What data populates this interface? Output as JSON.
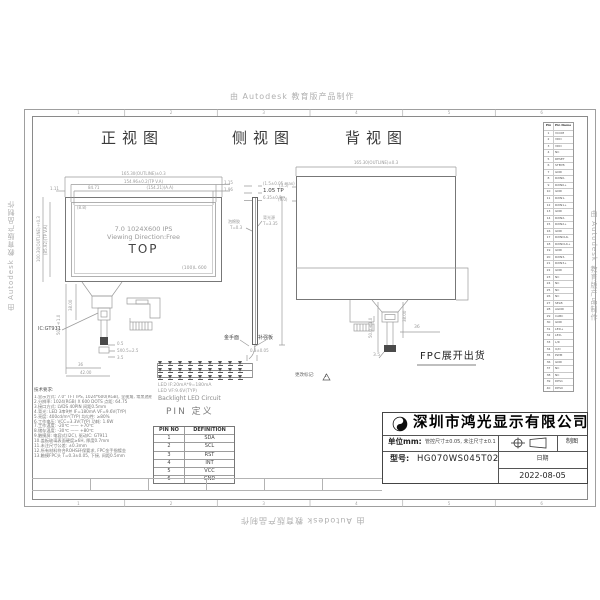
{
  "watermark": {
    "text": "由 Autodesk 教育版产品制作"
  },
  "zones": {
    "digits": [
      "1",
      "2",
      "3",
      "4",
      "5",
      "6"
    ]
  },
  "views": {
    "front": "正视图",
    "side": "侧视图",
    "back": "背视图"
  },
  "front": {
    "dim_outline": "165.30(OUTLINE)±0.3",
    "dim_tp": "154.96±0.2(TP V.A)",
    "dim_aa": "(154.21)(A.A)",
    "dim_aa_mid": "84.71",
    "dim_left_stub": "1.11",
    "dim_right_stub1": "1.15",
    "dim_right_stub2": "1.96",
    "dim_v_outline": "100.30(OUTLINE)±0.3",
    "dim_v_va": "(85.92)(TP V.A)",
    "corner_note": "(8.8)",
    "panel_line1": "7.0 1024X600 IPS",
    "panel_line2": "Viewing Direction:Free",
    "panel_line3": "TOP",
    "panel_corner": "(100)L 600",
    "ic_label": "IC:GT911",
    "fpc_len": "50.0±1.0",
    "fpc_38": "38.00",
    "fpc_d1": "0.5",
    "fpc_d2": "5X0.5=2.5",
    "fpc_d3": "3.5",
    "fpc_d4": "36",
    "fpc_d5": "42.00"
  },
  "side": {
    "dim1": "(1.5±0.05 max)",
    "dim2": "1.05 TP",
    "dim3": "6.35±0.3",
    "lbl_foam1": "泡棉胶",
    "lbl_foam2": "T=0.3",
    "lbl_bl1": "背光源",
    "lbl_bl2": "T=3.35",
    "lbl_gold": "金手面",
    "lbl_stiff": "补强板",
    "dim_bottom": "0.3±0.05"
  },
  "back": {
    "dim_outline": "165.30(OUTLINE)±0.3",
    "lbl_l1": "(3.5)",
    "lbl_l2": "(9.0)",
    "fpc_len": "50.0±1.0",
    "fpc_38": "38.00",
    "fpc_36": "36",
    "fpc_35": "3.5",
    "fpc_note": "FPC展开出货"
  },
  "rev": {
    "label": "更改标记:",
    "num": "1"
  },
  "led": {
    "line1": "LED IF:20mA*9=180mA",
    "line2": "LED VF:9.6V(TYP)",
    "line3": "Backlight LED Circuit"
  },
  "pin_def": {
    "title": "PIN 定义",
    "col1": "PIN NO",
    "col2": "DEFINITION",
    "rows": [
      [
        "1",
        "SDA"
      ],
      [
        "2",
        "SCL"
      ],
      [
        "3",
        "RST"
      ],
      [
        "4",
        "INT"
      ],
      [
        "5",
        "VCC"
      ],
      [
        "6",
        "GND"
      ]
    ]
  },
  "pin_table": {
    "col1": "Pin No.",
    "col2": "Pin Name",
    "rows": [
      [
        "1",
        "VCOM"
      ],
      [
        "2",
        "VDD"
      ],
      [
        "3",
        "VDD"
      ],
      [
        "4",
        "NC"
      ],
      [
        "5",
        "RESET"
      ],
      [
        "6",
        "STBYB"
      ],
      [
        "7",
        "GND"
      ],
      [
        "8",
        "RXIN0-"
      ],
      [
        "9",
        "RXIN0+"
      ],
      [
        "10",
        "GND"
      ],
      [
        "11",
        "RXIN1-"
      ],
      [
        "12",
        "RXIN1+"
      ],
      [
        "13",
        "GND"
      ],
      [
        "14",
        "RXIN2-"
      ],
      [
        "15",
        "RXIN2+"
      ],
      [
        "16",
        "GND"
      ],
      [
        "17",
        "RXINCLK-"
      ],
      [
        "18",
        "RXINCLK+"
      ],
      [
        "19",
        "GND"
      ],
      [
        "20",
        "RXIN3-"
      ],
      [
        "21",
        "RXIN3+"
      ],
      [
        "22",
        "GND"
      ],
      [
        "23",
        "NC"
      ],
      [
        "24",
        "NC"
      ],
      [
        "25",
        "NC"
      ],
      [
        "26",
        "NC"
      ],
      [
        "27",
        "SELB"
      ],
      [
        "28",
        "AGND"
      ],
      [
        "29",
        "CABC"
      ],
      [
        "30",
        "GND"
      ],
      [
        "31",
        "LED+"
      ],
      [
        "32",
        "LED-"
      ],
      [
        "33",
        "L/R"
      ],
      [
        "34",
        "U/D"
      ],
      [
        "35",
        "PWM"
      ],
      [
        "36",
        "GND"
      ],
      [
        "37",
        "NC"
      ],
      [
        "38",
        "NC"
      ],
      [
        "39",
        "DPS1"
      ],
      [
        "40",
        "DPS0"
      ]
    ]
  },
  "notes": {
    "title": "技术要求:",
    "lines": [
      "1.显示方式: 7.0\" TFT IPS, 1024*600(RGB), 全视角, 常黑透射",
      "2.分辨率: 1024(RGB) X 600 DOTS  点距: 64.75",
      "3.接口方式: LVDS 40PIN  间距0.5mm",
      "4.背光: LED 3串9并  IF=180mA  VF=9.6V(TYP)",
      "5.亮度: 400cd/m²(TYP)  均匀性: ≥80%",
      "6.工作电压: VCC=3.3V(TYP)  功耗: 1.6W",
      "7.工作温度: -20℃ —— +70℃",
      "8.储存温度: -30℃ —— +80℃",
      "9.触摸屏: 电容式(I2C), 驱动IC: GT911",
      "10.盖板玻璃表面硬度≥6H, 厚度0.7mm",
      "11.未注尺寸公差: ±0.3mm",
      "12.所有材料符合ROHS环保要求, FPC金手指镀金",
      "13.触摸FPC头 T=0.3±0.05, 下接, 间距0.5mm"
    ]
  },
  "title_block": {
    "company": "深圳市鸿光显示有限公司",
    "unit_label": "单位mm:",
    "unit_value": "管控尺寸±0.05, 未注尺寸±0.1",
    "model_label": "型号:",
    "model_value": "HG070WS045T02",
    "drawn": "制图",
    "date_label": "日期",
    "date_value": "2022-08-05"
  }
}
